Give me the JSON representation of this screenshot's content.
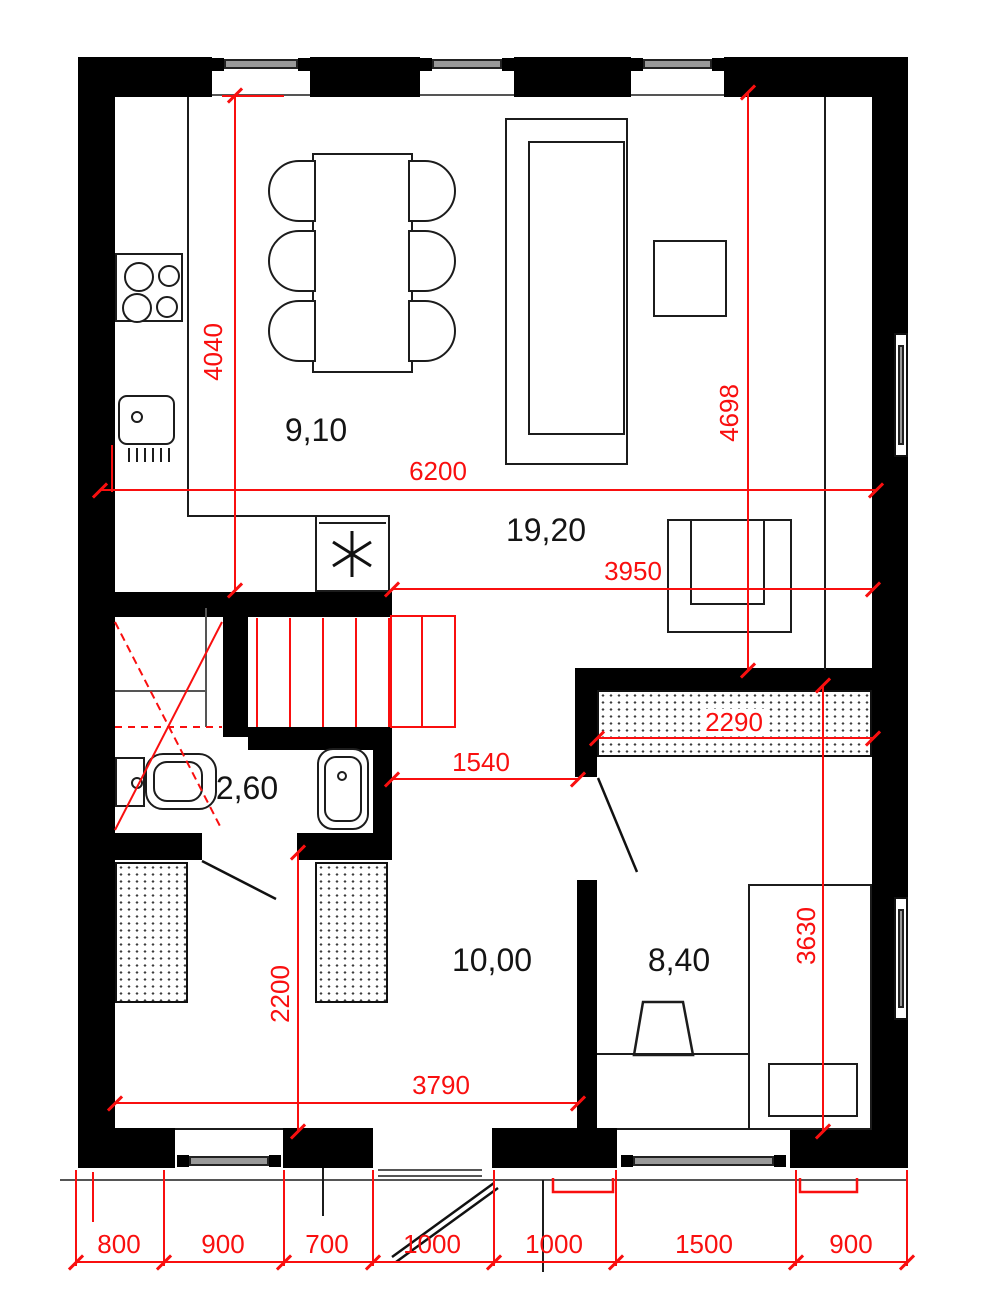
{
  "drawing": {
    "type": "apartment floor plan",
    "units": "mm",
    "areas_unit": "m2"
  },
  "colors": {
    "wall": "#000000",
    "dimension_red": "#f90f0f",
    "furniture_line": "#1c1c1c"
  },
  "rooms": {
    "kitchen_dining": {
      "label": "9,10"
    },
    "living": {
      "label": "19,20"
    },
    "bathroom": {
      "label": "2,60"
    },
    "hall_room": {
      "label": "10,00"
    },
    "bedroom": {
      "label": "8,40"
    }
  },
  "dims": {
    "kitchen_depth": "4040",
    "living_width": "6200",
    "living_inner_width": "3950",
    "living_depth": "4698",
    "bedroom_closet_width": "2290",
    "hall_width": "1540",
    "room_depth": "2200",
    "room_width": "3790",
    "bedroom_depth": "3630",
    "bottom_row": [
      "800",
      "900",
      "700",
      "1000",
      "1000",
      "1500",
      "900"
    ]
  }
}
